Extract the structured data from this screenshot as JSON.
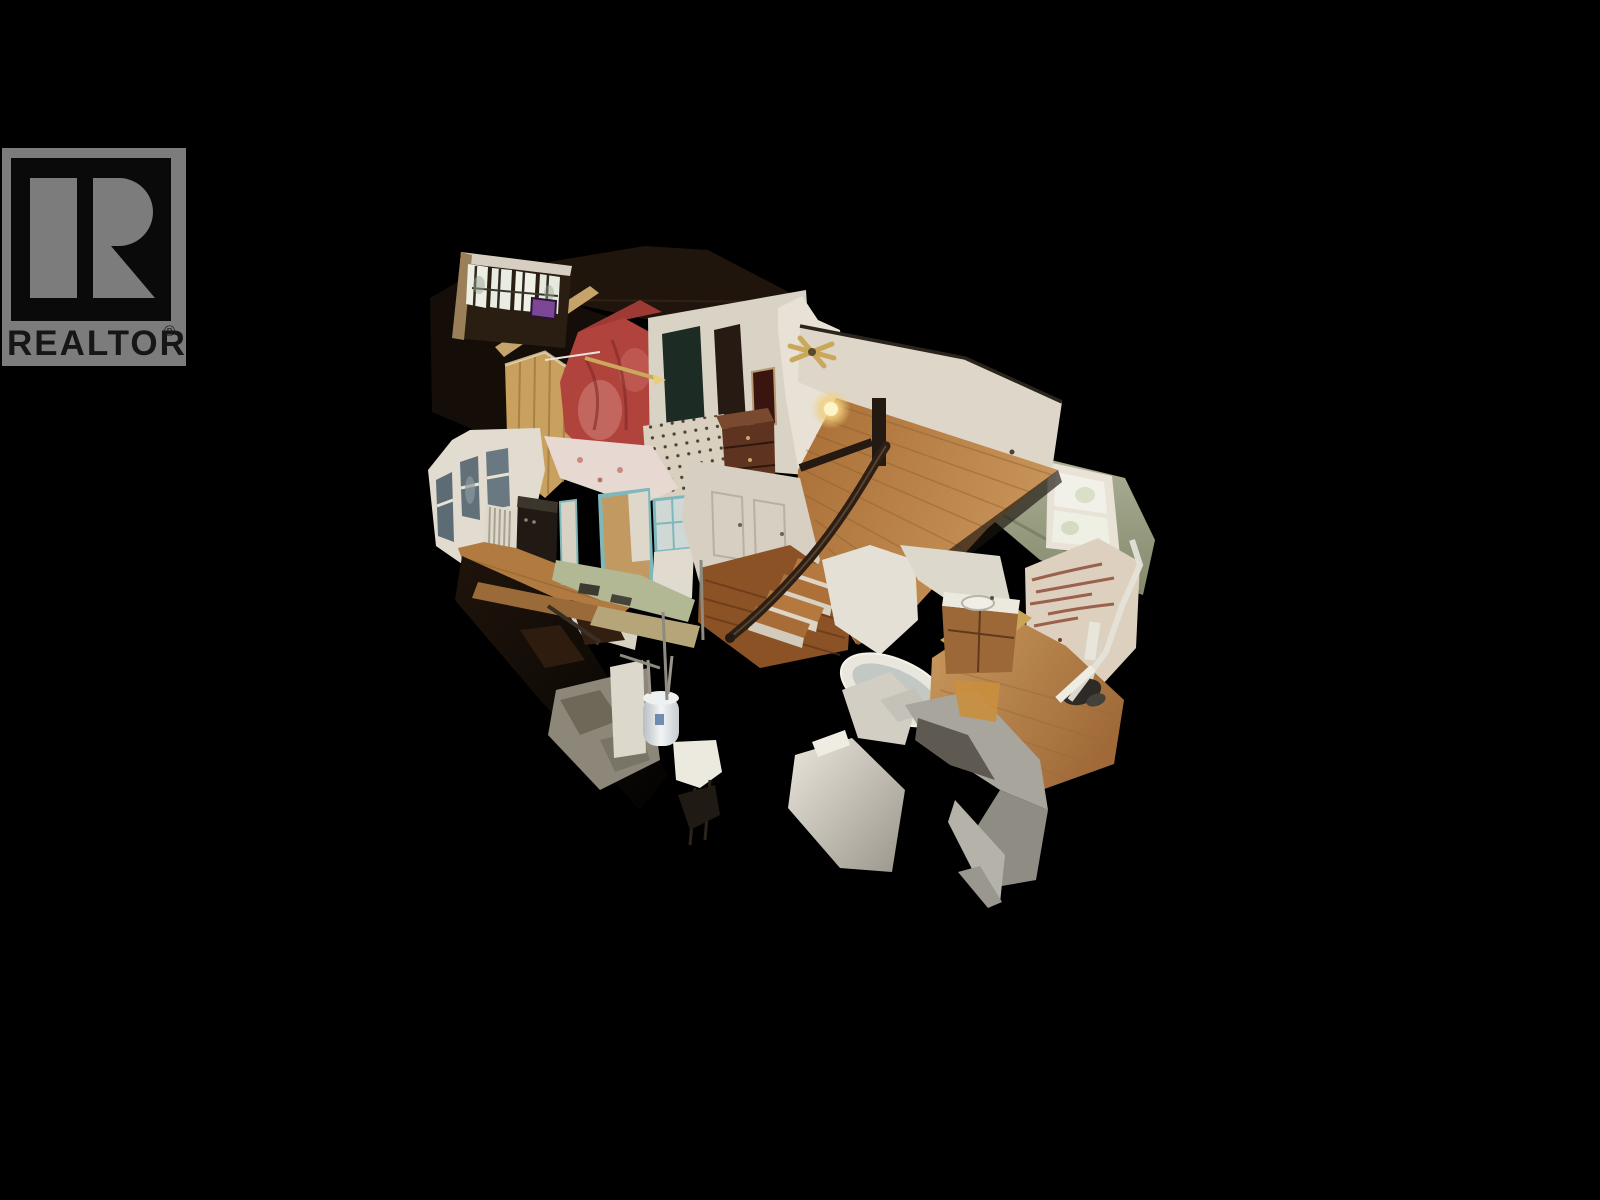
{
  "window": {
    "background_color": "#000000",
    "kind": "3d-home-tour-dollhouse-screenshot"
  },
  "watermark": {
    "text": "REALTOR",
    "registered": "®",
    "logo_letter": "R",
    "icon": "realtor-block-r-logo",
    "colors": {
      "block_gray": "#7c7c7c",
      "inner_black": "#0a0a0a",
      "text_dark": "#161616"
    }
  },
  "scene": {
    "kind": "3d-dollhouse-cutaway",
    "subject": "Cutaway dollhouse view of a two-story house interior scan on a black background",
    "palette": {
      "roof_dark": "#1a120b",
      "white_wall": "#ded8cb",
      "wood_floor": "#b5783e",
      "red_wall": "#b0433c",
      "pine_panel": "#c9a05e",
      "sage_green_wall": "#a3a88e",
      "teal_trim": "#7fb8bc",
      "daylight_window": "#f0efe6",
      "purple_window": "#7b4796",
      "concrete": "#8d8779",
      "mesh_gray": "#a8a59c"
    }
  }
}
